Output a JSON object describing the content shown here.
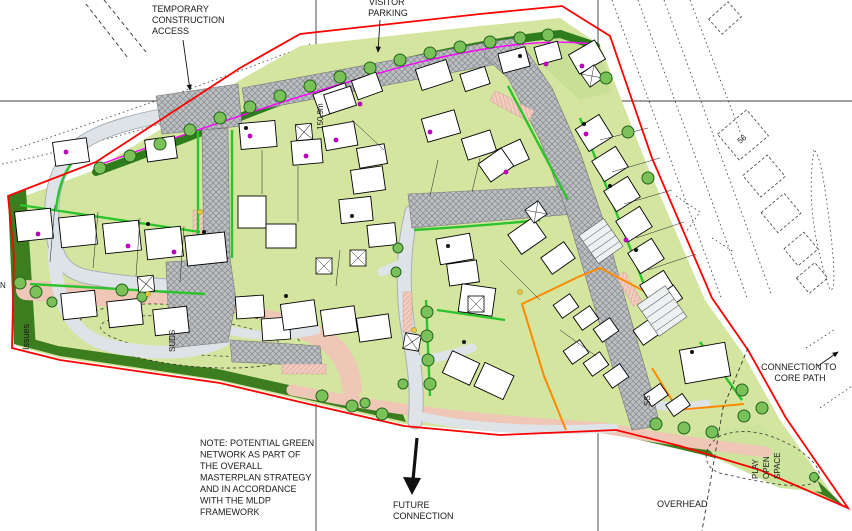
{
  "drawing": {
    "type": "housing-development-site-masterplan",
    "labels": {
      "temporary_access": {
        "lines": [
          "TEMPORARY",
          "CONSTRUCTION",
          "ACCESS"
        ]
      },
      "visitor_parking": {
        "lines": [
          "VISITOR",
          "PARKING"
        ]
      },
      "level_marker": "150.9m",
      "issues": "Issues",
      "n_partial": "N",
      "suds": "SUDS",
      "note": {
        "lines": [
          "NOTE: POTENTIAL GREEN",
          "NETWORK AS PART OF",
          "THE OVERALL",
          "MASTERPLAN STRATEGY",
          "AND IN ACCORDANCE",
          "WITH THE MLDP",
          "FRAMEWORK"
        ]
      },
      "future_connection": {
        "lines": [
          "FUTURE",
          "CONNECTION"
        ]
      },
      "connection_core_path": {
        "lines": [
          "CONNECTION TO",
          "CORE PATH"
        ]
      },
      "overhead": "OVERHEAD",
      "play_open_space": {
        "lines": [
          "PLAY",
          "OPEN",
          "SPACE"
        ]
      },
      "existing_house_number": "56",
      "substation": "SS"
    },
    "colors": {
      "site_boundary_red": "#ff0000",
      "fence_magenta": "#ff00ff",
      "phase_boundary_orange": "#ff8a00",
      "greenspace_light": "#d3e59f",
      "buffer_planting_dark": "#3c7d1f",
      "hedge_green": "#2cc42c",
      "road_grey": "#dde3e6",
      "block_paving_grey": "#bcc0c2",
      "footpath_pink": "#eec7b7",
      "house_white": "#ffffff",
      "tree_green": "#79c158",
      "marker_purple": "#bb00bb"
    }
  }
}
